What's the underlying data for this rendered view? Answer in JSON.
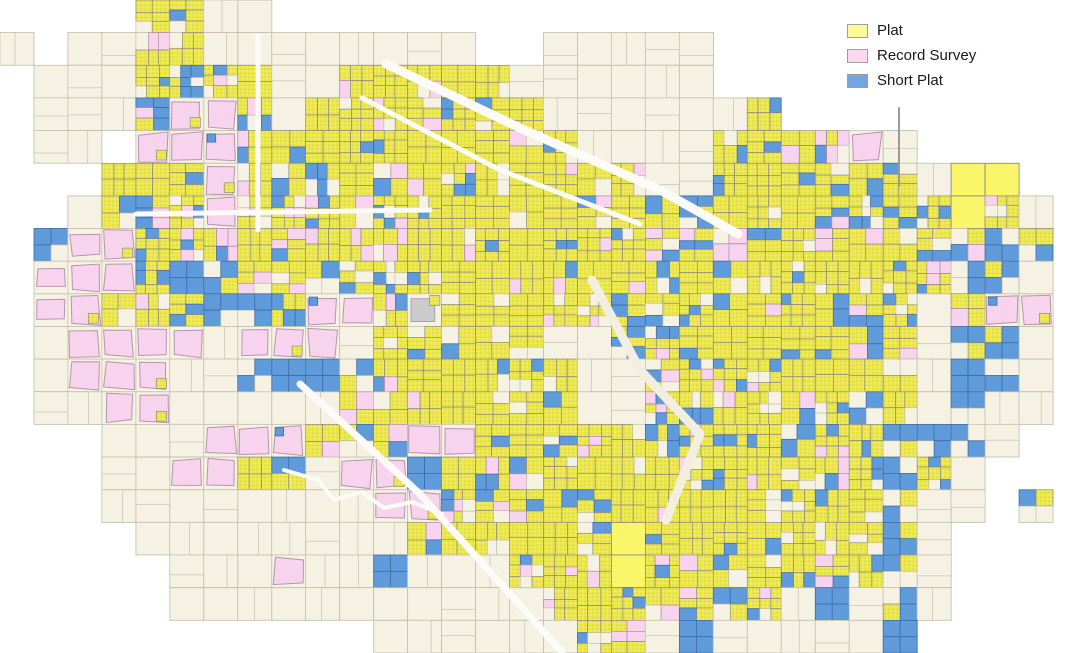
{
  "legend": {
    "items": [
      {
        "label": "Plat",
        "color": "#fcfa9b"
      },
      {
        "label": "Record Survey",
        "color": "#fbd9f1"
      },
      {
        "label": "Short Plat",
        "color": "#74a4e6"
      }
    ]
  },
  "map": {
    "width": 1087,
    "height": 653,
    "viewbox": "0 0 1087 653",
    "seed": 7,
    "palette": {
      "plat_fill": "#ece74d",
      "plat_dot_dark": "#c9c43e",
      "plat_dot_light": "#f7f39a",
      "plat_bright": "#fbf56a",
      "survey_fill": "#f8d3ee",
      "survey_edge": "#b793ae",
      "short_fill": "#5f9adb",
      "short_edge": "#3e6da9",
      "vacant_fill": "#f6f2e3",
      "vacant_edge": "#c6c1af",
      "parcel_edge": "#8d8c80",
      "gray_fill": "#cbcbcb",
      "gray_edge": "#9b9b9b",
      "road": "#fcfbf7",
      "corridor": "#f3efe0",
      "outside": "#ffffff"
    },
    "grid": {
      "cols": 32,
      "rows": 20,
      "classes": {
        ".": "outside-empty",
        "c": "vacant-parcels",
        "y": "plat-dense",
        "m": "mixed-plat-shortplat-survey",
        "p": "record-survey-area",
        "q": "record-survey-over-vacant",
        "b": "short-plat-cluster",
        "Y": "large-solid-plat",
        "g": "gray-parcel-patch"
      },
      "rows_data": [
        "....yycc........................",
        "c.ccyycccccccc..ccccc...........",
        ".cccymmmccyyyyycccccc...........",
        ".cccmppmcyyyyyyyccccccy.........",
        ".cc.pppmyyyyyyyyyccccyymmpc.....",
        "...yympmymyyyyyyyyyccyyymmmcYY..",
        "..cmmmpmmmmmyyyyyyymmmyymmmmYmc.",
        ".bqpmmmmmmmmyyyyyymmmmyyymmmmbb.",
        ".qppmbbmmmmmyyyyyyymmmmyyymmbbc.",
        ".qpmmmbbmppmgyyyymmmmmyyymmcmpp.",
        ".cppppcpppcyyyyyccmmmyyyymmcbbc.",
        ".cpppccbbbbmyyyyyccmmyyyymbcbbc.",
        ".ccppcccccmyyyyyyccmmyyyybmcbcc.",
        "...cccpppmbmppmyyyymmyyyymbbbc..",
        "...ccppmbcppbmyyyyyymyyymmbmc...",
        "...ccccccccppmyyyyyyyyymmmbcc.b.",
        "....ccccccccmyyyyyYyyyyymmbc....",
        ".....cccpccbcccmyyYymyymmmbc....",
        ".....cccccccccccmyymmbmcbcbc....",
        "...........ccccccymcbcccccb....."
      ]
    },
    "roads": [
      {
        "name": "nw-diagonal-highway",
        "points": [
          [
            386,
            64
          ],
          [
            520,
            128
          ],
          [
            660,
            190
          ],
          [
            738,
            234
          ]
        ],
        "width": 9,
        "color": "#fcfbf7"
      },
      {
        "name": "nw-parallel-road",
        "points": [
          [
            362,
            98
          ],
          [
            500,
            170
          ],
          [
            640,
            224
          ]
        ],
        "width": 5,
        "color": "#fcfbf7"
      },
      {
        "name": "north-vertical-road",
        "points": [
          [
            258,
            36
          ],
          [
            258,
            230
          ]
        ],
        "width": 5,
        "color": "#fcfbf7"
      },
      {
        "name": "west-horizontal-road",
        "points": [
          [
            136,
            214
          ],
          [
            430,
            210
          ]
        ],
        "width": 5,
        "color": "#fcfbf7"
      },
      {
        "name": "sw-diagonal-road",
        "points": [
          [
            300,
            384
          ],
          [
            420,
            494
          ],
          [
            562,
            652
          ]
        ],
        "width": 7,
        "color": "#fcfbf7"
      },
      {
        "name": "central-corridor",
        "points": [
          [
            592,
            280
          ],
          [
            640,
            370
          ],
          [
            700,
            434
          ],
          [
            666,
            520
          ]
        ],
        "width": 9,
        "color": "#f3efe0"
      },
      {
        "name": "sw-river",
        "points": [
          [
            284,
            470
          ],
          [
            318,
            480
          ],
          [
            334,
            500
          ],
          [
            362,
            492
          ],
          [
            384,
            508
          ],
          [
            412,
            502
          ],
          [
            442,
            514
          ]
        ],
        "width": 4,
        "color": "#fcfbf7"
      },
      {
        "name": "legend-area-gray-line",
        "points": [
          [
            899,
            108
          ],
          [
            899,
            186
          ]
        ],
        "width": 2,
        "color": "#9a9a9a"
      }
    ]
  }
}
